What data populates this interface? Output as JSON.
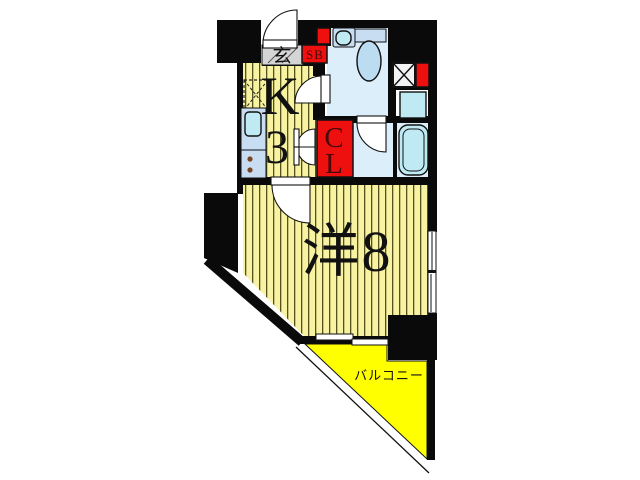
{
  "plan": {
    "labels": {
      "entrance": "玄",
      "shoe_box": "SB",
      "kitchen_letter": "K",
      "kitchen_size": "3",
      "closet_line1": "C",
      "closet_line2": "L",
      "main_room": "洋8",
      "balcony": "バルコニー"
    },
    "colors": {
      "wall": "#0a0a0a",
      "floor": "#f8f3a2",
      "floor_stripe": "#55521f",
      "balcony": "#ffff00",
      "entrance_tile": "#d5d5d5",
      "bath_floor": "#dceef9",
      "fixture_cyan": "#bfeaf4",
      "fixture_blue": "#bcdcf2",
      "counter": "#c8dcf2",
      "accent_red": "#ee0f0f",
      "label_dark": "#4a0808"
    }
  }
}
